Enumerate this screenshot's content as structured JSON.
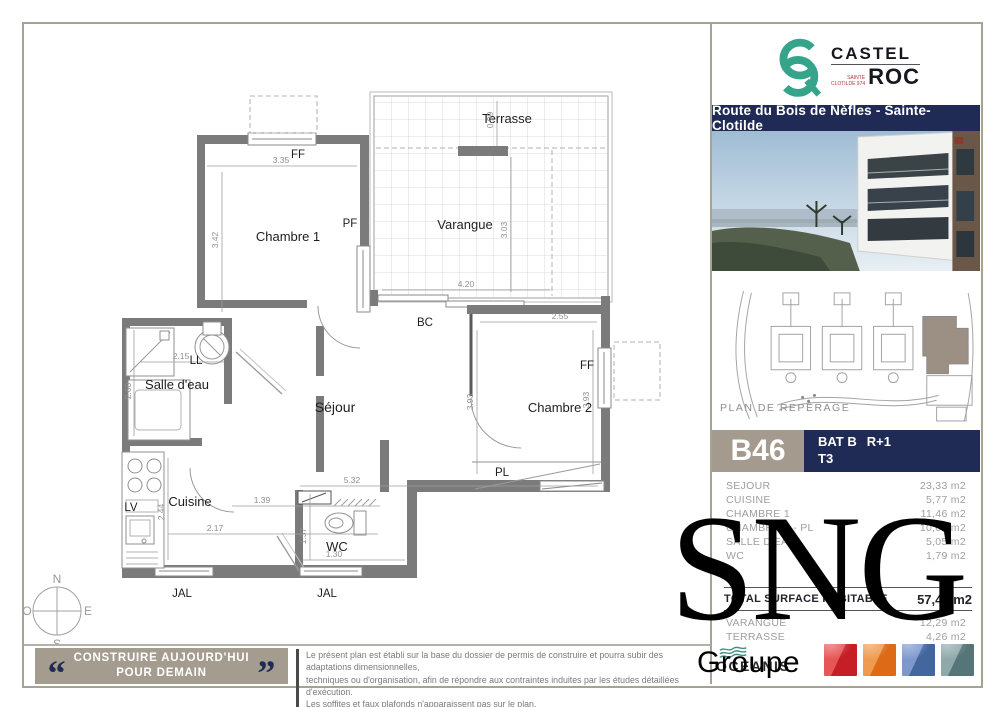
{
  "brand": {
    "monogram": "CR",
    "name_line1": "CASTEL",
    "name_line2": "ROC",
    "sub_line1": "SAINTE",
    "sub_line2": "CLOTILDE 974",
    "accent_color": "#36a38b"
  },
  "banner": {
    "title": "Route du Bois de Nèfles - Sainte-Clotilde",
    "bg_color": "#1f2a55"
  },
  "site_plan": {
    "caption": "PLAN DE REPÉRAGE",
    "highlight_color": "#9c9084"
  },
  "unit": {
    "code": "B46",
    "building": "BAT B",
    "floor": "R+1",
    "type": "T3"
  },
  "surfaces": {
    "rows": [
      {
        "label": "SEJOUR",
        "value": "23,33 m2"
      },
      {
        "label": "CUISINE",
        "value": "5,77 m2"
      },
      {
        "label": "CHAMBRE 1",
        "value": "11,46 m2"
      },
      {
        "label": "CHAMBRE 2 - PL",
        "value": "10,01 m2"
      },
      {
        "label": "SALLE D'EAU",
        "value": "5,05 m2"
      },
      {
        "label": "WC",
        "value": "1,79 m2"
      }
    ],
    "total_label": "TOTAL SURFACE HABITABLE",
    "total_value": "57,41 m2",
    "extra_rows": [
      {
        "label": "VARANGUE",
        "value": "12,29 m2"
      },
      {
        "label": "TERRASSE",
        "value": "4,26 m2"
      }
    ]
  },
  "footer": {
    "quote_open": "“",
    "quote_close": "”",
    "slogan_line1": "CONSTRUIRE AUJOURD'HUI",
    "slogan_line2": "POUR DEMAIN",
    "disclaimer_line1": "Le présent plan est établi sur la base du dossier de permis de construire et pourra subir des adaptations dimensionnelles,",
    "disclaimer_line2": "techniques ou d'organisation, afin de répondre aux contraintes induites par les études détaillées d'exécution.",
    "disclaimer_line3": "Les soffites et faux plafonds n'apparaissent pas sur le plan.",
    "partner_name": "OCEANIS",
    "swatch_colors": [
      "#c51e26",
      "#dd6a17",
      "#44669f",
      "#557578"
    ]
  },
  "watermark": {
    "line1": "SNG",
    "line2": "Groupe"
  },
  "plan": {
    "labels": {
      "terrasse": "Terrasse",
      "varangue": "Varangue",
      "chambre1": "Chambre 1",
      "chambre2": "Chambre 2",
      "sejour": "Séjour",
      "salle_deau": "Salle d'eau",
      "cuisine": "Cuisine",
      "wc": "WC",
      "bc": "BC",
      "pl": "PL",
      "ff": "FF",
      "pf": "PF",
      "ll": "LL",
      "lv": "LV",
      "jal": "JAL"
    },
    "dims": {
      "d335": "3.35",
      "d342": "3.42",
      "d099": "0.99",
      "d303": "3.03",
      "d420": "4.20",
      "d255": "2.55",
      "d393": "3.93",
      "d215": "2.15",
      "d260": "2.60",
      "d244": "2.44",
      "d217": "2.17",
      "d139": "1.39",
      "d532": "5.32",
      "d137": "1.37",
      "d130": "1.30"
    },
    "compass": {
      "n": "N",
      "s": "S",
      "e": "E",
      "o": "O"
    }
  }
}
